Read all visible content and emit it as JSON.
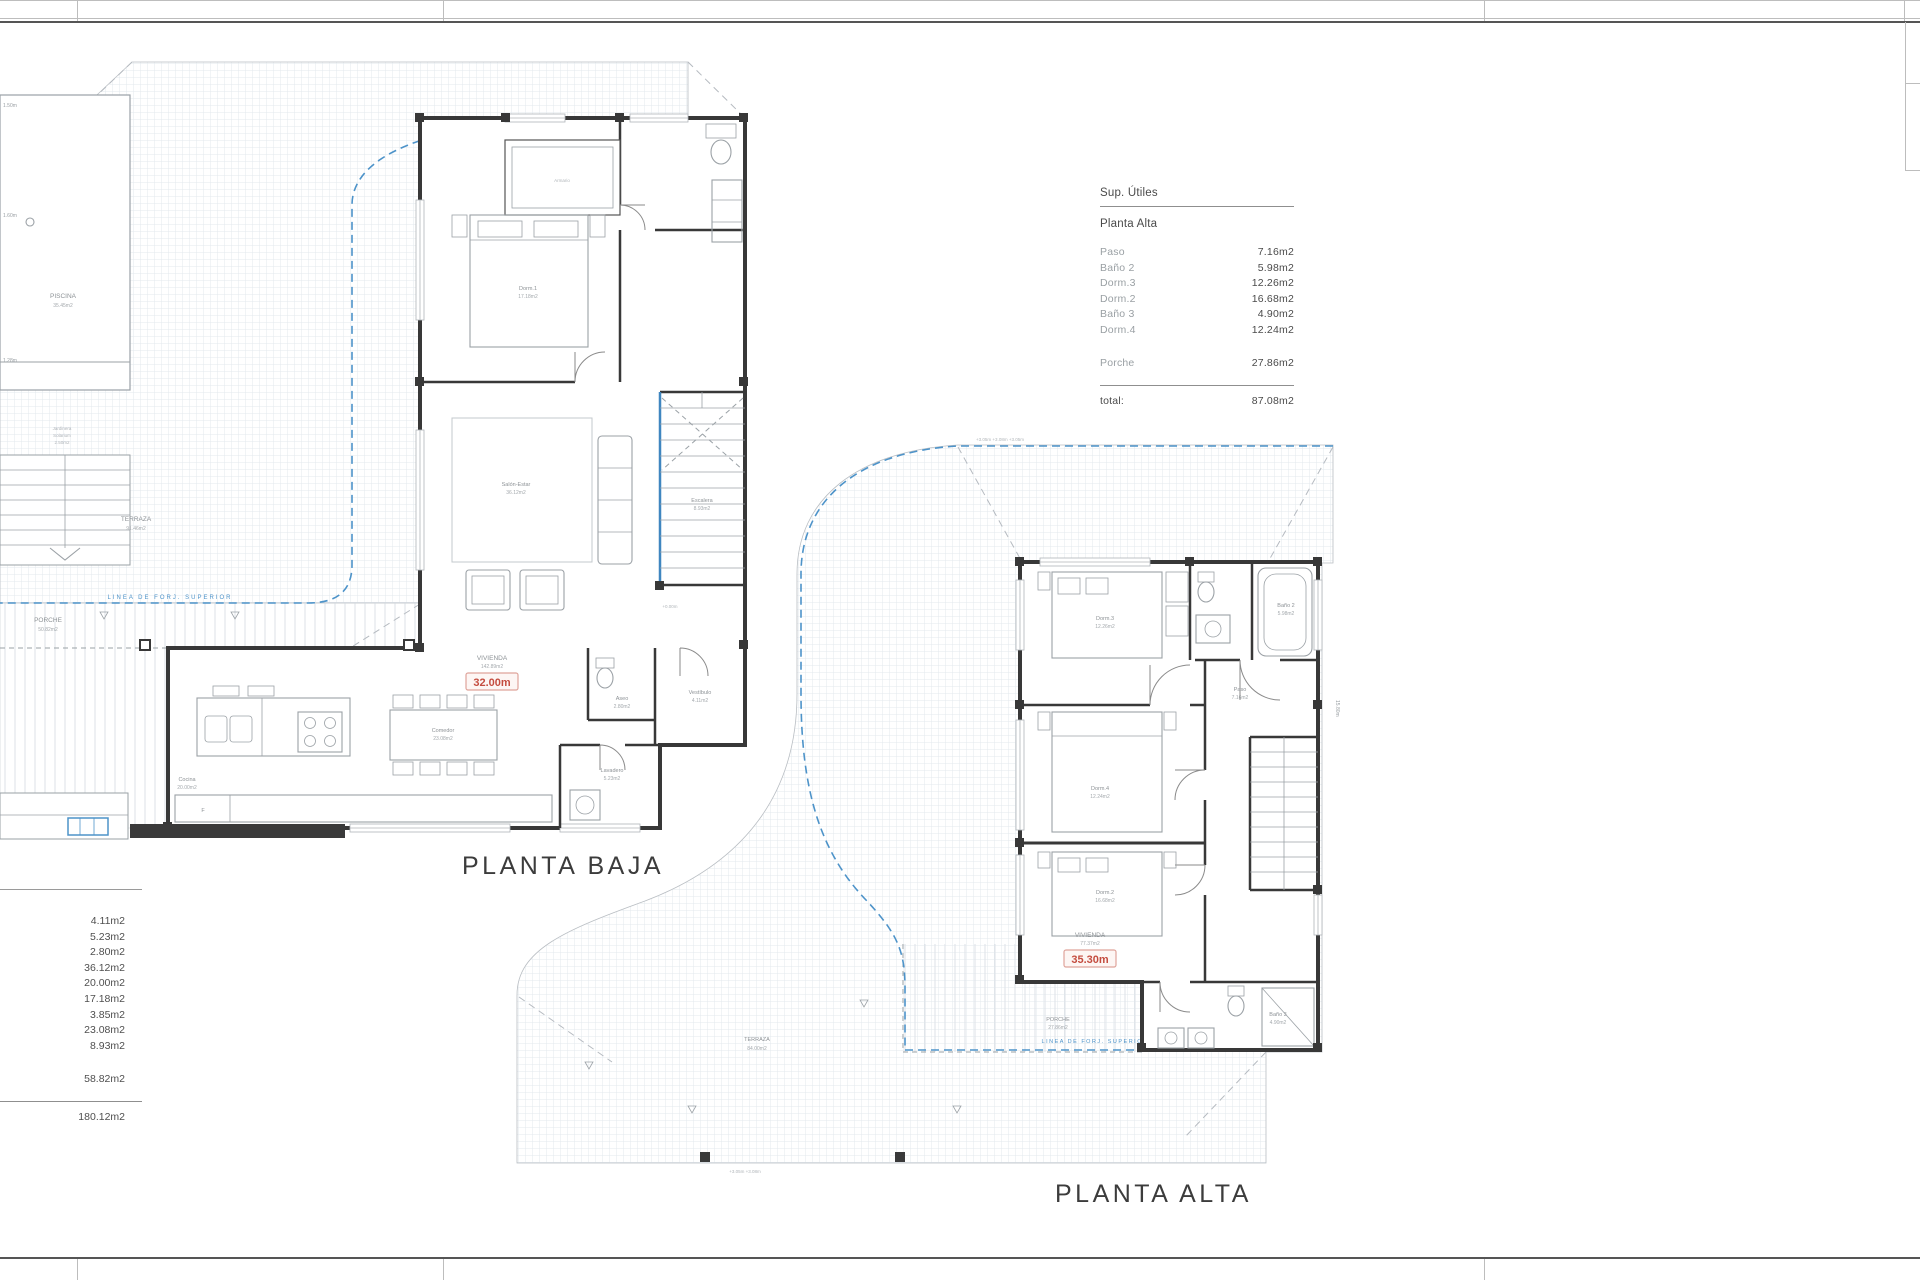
{
  "colors": {
    "accent_blue": "#4d93c9",
    "accent_red": "#c44c3f"
  },
  "sup_utiles": {
    "title": "Sup. Útiles",
    "section": "Planta Alta",
    "rows": [
      {
        "label": "Paso",
        "value": "7.16m2"
      },
      {
        "label": "Baño 2",
        "value": "5.98m2"
      },
      {
        "label": "Dorm.3",
        "value": "12.26m2"
      },
      {
        "label": "Dorm.2",
        "value": "16.68m2"
      },
      {
        "label": "Baño 3",
        "value": "4.90m2"
      },
      {
        "label": "Dorm.4",
        "value": "12.24m2"
      }
    ],
    "porche": {
      "label": "Porche",
      "value": "27.86m2"
    },
    "total": {
      "label": "total:",
      "value": "87.08m2"
    }
  },
  "left_table": {
    "values": [
      "4.11m2",
      "5.23m2",
      "2.80m2",
      "36.12m2",
      "20.00m2",
      "17.18m2",
      "3.85m2",
      "23.08m2",
      "8.93m2"
    ],
    "subtotal": "58.82m2",
    "total": "180.12m2"
  },
  "planta_baja": {
    "title": "PLANTA BAJA",
    "vivienda_label": "VIVIENDA",
    "vivienda_area": "142.89m2",
    "cota_roja": "32.00m",
    "linea_forjado": "LINEA DE FORJ. SUPERIOR",
    "piscina": "PISCINA",
    "piscina_area": "35.45m2",
    "terraza": "TERRAZA",
    "terraza_area": "91.46m2",
    "porche": "PORCHE",
    "porche_area": "50.82m2",
    "dorm1": "Dorm.1",
    "dorm1_area": "17.18m2",
    "salon": "Salón-Estar",
    "salon_area": "36.12m2",
    "escalera": "Escalera",
    "escalera_area": "8.93m2",
    "cocina": "Cocina",
    "cocina_area": "20.00m2",
    "comedor": "Comedor",
    "comedor_area": "23.08m2",
    "aseo": "Aseo",
    "aseo_area": "2.80m2",
    "vestibulo": "Vestíbulo",
    "vestibulo_area": "4.11m2",
    "lavadero": "Lavadero",
    "lavadero_area": "5.23m2",
    "armario": "Armario",
    "fridge": "F",
    "nivel": "+0.00m",
    "dim1": "1.50m",
    "dim2": "1.60m",
    "dim3": "1.28m",
    "micro1": "Jardinera",
    "micro2": "Solarium",
    "micro3": "2.50m2"
  },
  "planta_alta": {
    "title": "PLANTA ALTA",
    "vivienda_label": "VIVIENDA",
    "vivienda_area": "77.37m2",
    "cota_roja": "35.30m",
    "linea_forjado": "LINEA DE FORJ. SUPERIOR",
    "terraza": "TERRAZA",
    "terraza_area": "84.00m2",
    "porche": "PORCHE",
    "porche_area": "27.86m2",
    "dorm3": "Dorm.3",
    "dorm3_area": "12.26m2",
    "dorm4": "Dorm.4",
    "dorm4_area": "12.24m2",
    "dorm2": "Dorm.2",
    "dorm2_area": "16.68m2",
    "bano2": "Baño 2",
    "bano2_area": "5.98m2",
    "bano3": "Baño 3",
    "bano3_area": "4.90m2",
    "paso": "Paso",
    "paso_area": "7.16m2",
    "niveles_top": "+3.05m      +3.08m      +3.05m",
    "niveles_bottom": "+3.05m   +3.08m",
    "dim_right": "15.80m"
  }
}
